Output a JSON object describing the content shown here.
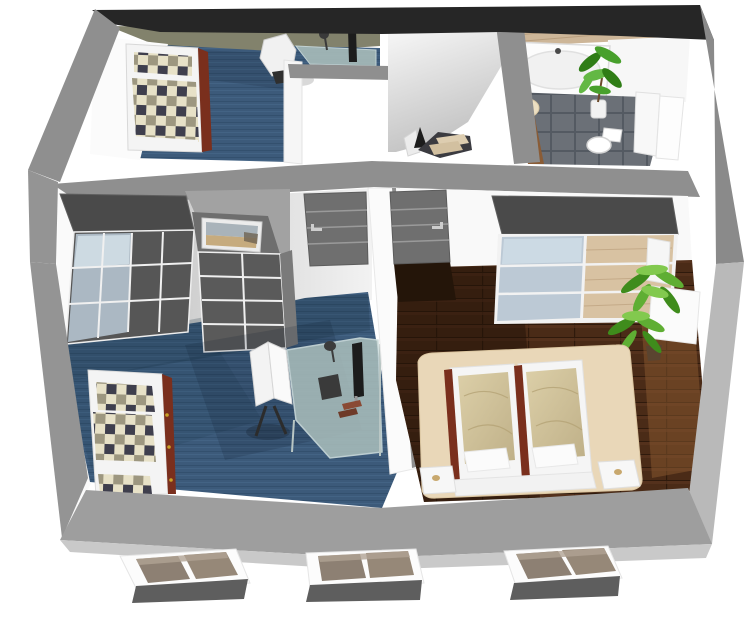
{
  "scene": {
    "title": "3D attic floor plan cutaway",
    "view": "isometric cutaway from above",
    "style": {
      "background": "#ffffff",
      "cut_wall_dark": "#262626",
      "cut_wall_gray": "#8f8f8f",
      "cut_wall_light": "#b9b9b9",
      "slab_gray": "#9e9e9e",
      "slab_bevel": "#c9c9c9",
      "inner_wall_white": "#f9f9f9",
      "inner_wall_shadow": "#a2a2a2",
      "sloped_ceiling_khaki": "#82826c",
      "carpet_blue": "#3c5a7a",
      "carpet_shadow": "#142838",
      "wood_floor_brown": "#4a2b17",
      "wood_panel_light": "#cdb698",
      "tile_gray": "#6b7077",
      "wardrobe_gray": "#565656",
      "wardrobe_top_gray": "#4a4a4a",
      "wardrobe_glass": "#b7c6d3",
      "wardrobe_wood": "#d8c2a2",
      "door_gray": "#6f6f6f",
      "door_stripe": "#9a9a9a",
      "handle_silver": "#cdcdcd",
      "bed_frame_white": "#f4f4f4",
      "bed_rail_mahogany": "#7a2f1d",
      "brass_dot": "#c9a227",
      "plaid_cream": "#e7e1c7",
      "plaid_dark": "#3f3f4d",
      "plaid_olive": "#9d9780",
      "duvet_tan": "#cfc098",
      "platform_beige": "#e9d7b8",
      "rug_beige": "#ecdfc2",
      "desk_glass": "#a8bcba",
      "monitor_black": "#1c1c1c",
      "plant_green_dark": "#3f8c1c",
      "plant_green_mid": "#5fae33",
      "plant_green_light": "#82c94e",
      "stair_tread_wood": "#ddcdb0",
      "stair_stringer": "#3b3b40",
      "dormer_pane": "#8d8073",
      "dormer_pane_light": "#968878",
      "dormer_base": "#5e5e5e",
      "tub_white": "#fcfcfc",
      "toilet_white": "#ffffff"
    },
    "rooms": [
      {
        "name": "kids-bedroom",
        "position": "top-left",
        "floor": "blue carpet",
        "furniture": [
          "single bed with plaid blanket",
          "glass desk with monitor and lamp",
          "white swivel chair"
        ]
      },
      {
        "name": "landing",
        "position": "top-center",
        "floor": "white",
        "furniture": [
          "staircase with wooden treads, dark stringer and white railing"
        ]
      },
      {
        "name": "bathroom",
        "position": "top-right",
        "floor": "gray tiles with wood strip",
        "furniture": [
          "bathtub",
          "round beige rug",
          "potted plant",
          "toilet",
          "white partition panels"
        ]
      },
      {
        "name": "kids-room-office",
        "position": "center-left",
        "floor": "blue carpet",
        "furniture": [
          "wardrobe with glass sliding doors",
          "dresser with framed beach picture",
          "single bed with plaid blanket",
          "glass corner desk",
          "monitor",
          "desk lamp",
          "white swivel chair",
          "gray paneled door"
        ]
      },
      {
        "name": "master-bedroom",
        "position": "center-right",
        "floor": "dark wood planks",
        "furniture": [
          "sliding wardrobe with glass and wood doors",
          "double bed with tan duvets on beige platform",
          "two nightstands",
          "potted palm plant",
          "white sideboards",
          "gray paneled door"
        ]
      }
    ],
    "exterior": {
      "dormer_windows": 3
    }
  }
}
